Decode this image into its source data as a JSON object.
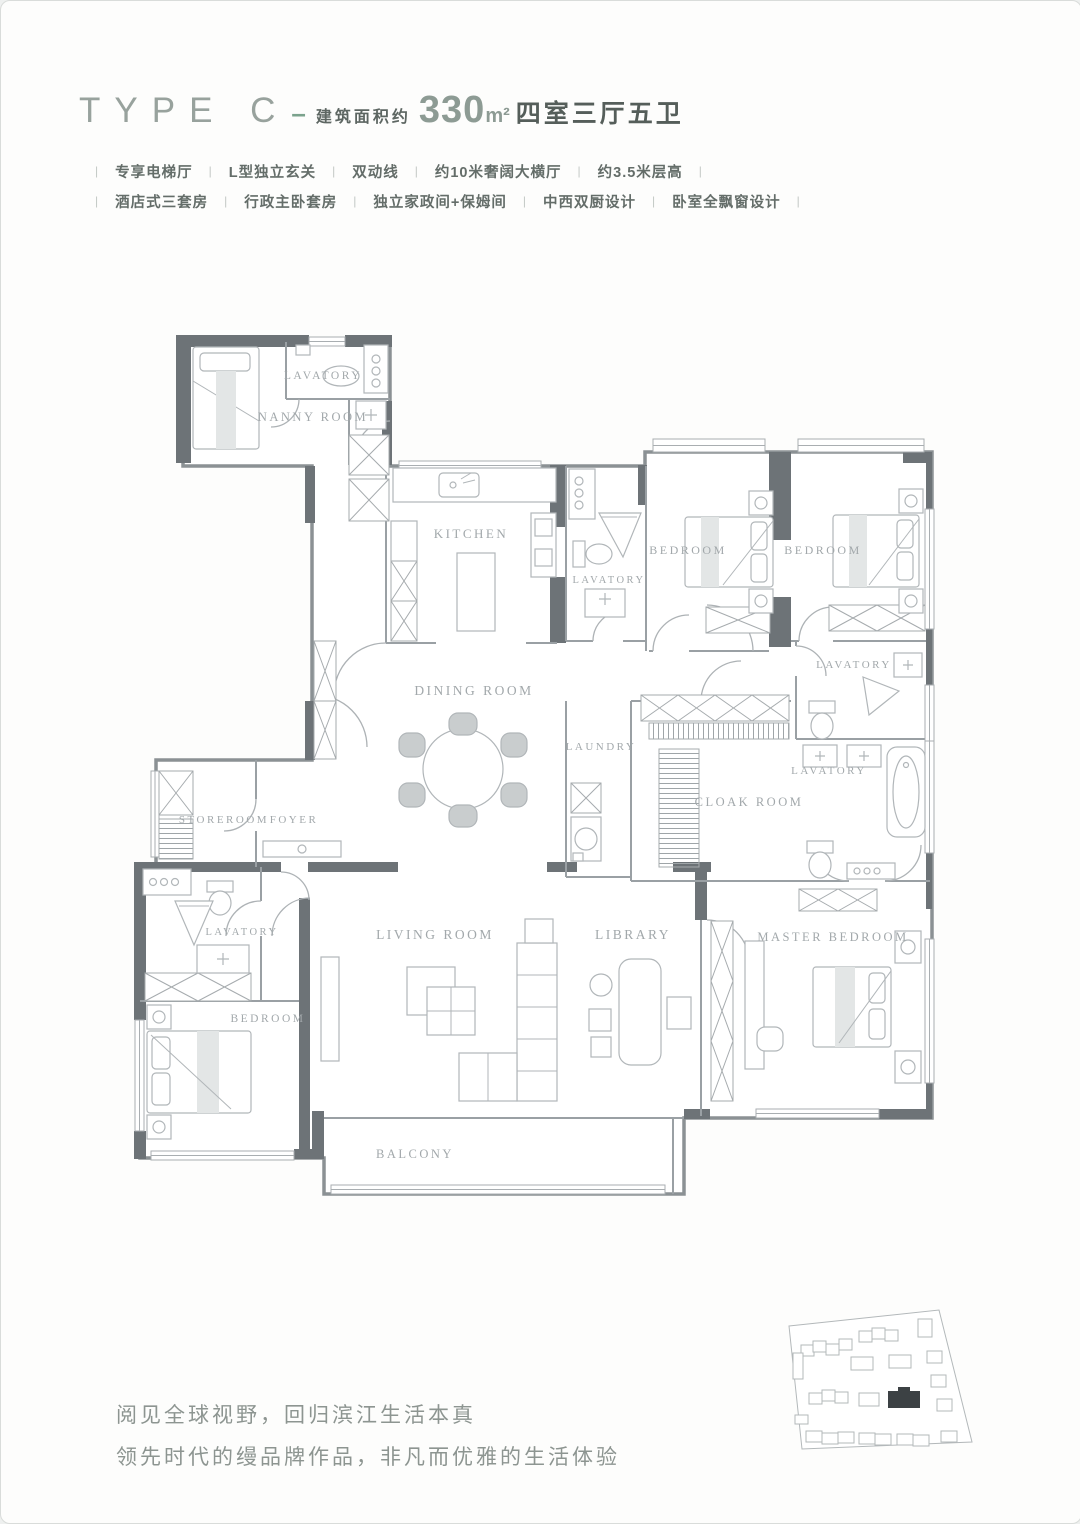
{
  "header": {
    "type_label": "TYPE C",
    "dash": "–",
    "area_prefix": "建筑面积约",
    "area_value": "330",
    "area_unit": "m²",
    "layout_text": "四室三厅五卫"
  },
  "features": {
    "sep": "|",
    "row1": [
      "专享电梯厅",
      "L型独立玄关",
      "双动线",
      "约10米奢阔大横厅",
      "约3.5米层高"
    ],
    "row2": [
      "酒店式三套房",
      "行政主卧套房",
      "独立家政间+保姆间",
      "中西双厨设计",
      "卧室全飘窗设计"
    ]
  },
  "plan": {
    "rooms": [
      {
        "label": "LAVATORY"
      },
      {
        "label": "NANNY ROOM"
      },
      {
        "label": "KITCHEN"
      },
      {
        "label": "LAVATORY"
      },
      {
        "label": "BEDROOM"
      },
      {
        "label": "BEDROOM"
      },
      {
        "label": "LAVATORY"
      },
      {
        "label": "DINING ROOM"
      },
      {
        "label": "LAUNDRY"
      },
      {
        "label": "LAVATORY"
      },
      {
        "label": "CLOAK ROOM"
      },
      {
        "label": "STOREROOM"
      },
      {
        "label": "FOYER"
      },
      {
        "label": "LAVATORY"
      },
      {
        "label": "BEDROOM"
      },
      {
        "label": "LIVING ROOM"
      },
      {
        "label": "LIBRARY"
      },
      {
        "label": "MASTER BEDROOM"
      },
      {
        "label": "BALCONY"
      }
    ]
  },
  "tagline": {
    "line1": "阅见全球视野，回归滨江生活本真",
    "line2": "领先时代的缦品牌作品，非凡而优雅的生活体验"
  },
  "colors": {
    "accent_green": "#7ba38d",
    "wall_dark": "#6d7377",
    "highlight_building": "#3c4144"
  }
}
